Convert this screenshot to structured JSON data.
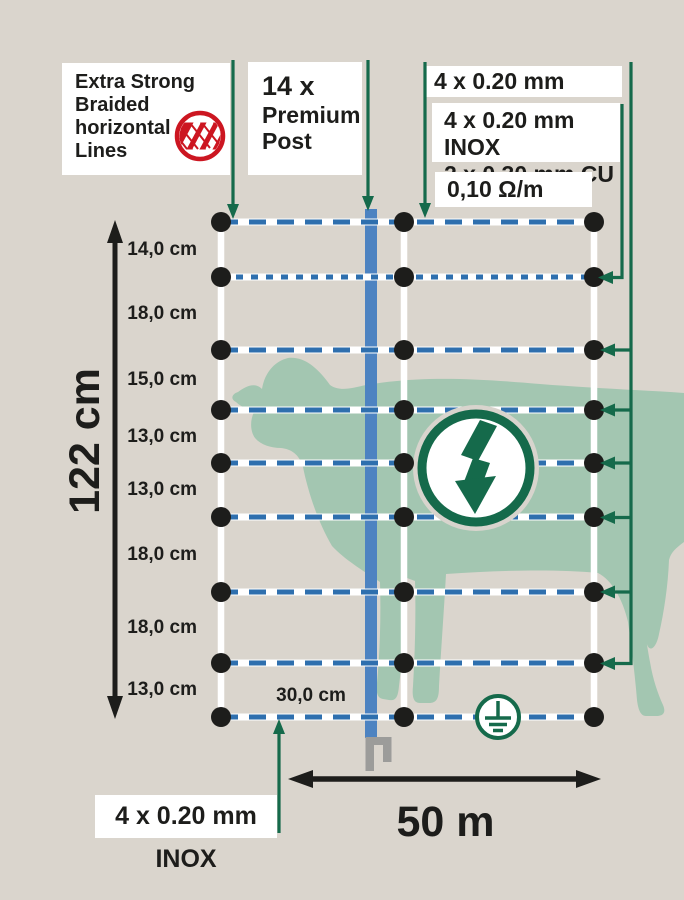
{
  "page": {
    "title": "Sheep netting product diagram",
    "background": "#dad5cd"
  },
  "colors": {
    "background": "#dad5cd",
    "accent_green": "#156a4b",
    "wire_blue": "#2e6fae",
    "post_blue": "#4d83c1",
    "sheep_green": "#a3c6b1",
    "logo_red": "#cc1621",
    "text_black": "#1d1d1b",
    "spike_gray": "#9c9c9a",
    "box_white": "#ffffff"
  },
  "braided_box": {
    "line1": "Extra Strong",
    "line2": "Braided",
    "line3": "horizontal",
    "line4": "Lines"
  },
  "post_box": {
    "count": "14 x",
    "line1": "Premium",
    "line2": "Post"
  },
  "labels": {
    "top_wire": "4 x 0.20 mm INOX",
    "conductors_line1": "4 x 0.20 mm INOX",
    "conductors_line2": "2 x 0.30 mm CU",
    "resistance": "0,10 Ω/m",
    "bottom_wire": "4 x 0.20 mm INOX",
    "net_height": "122 cm",
    "net_length": "50 m",
    "vertical_spacing": "30,0 cm"
  },
  "line_spacings": [
    "14,0 cm",
    "18,0 cm",
    "15,0 cm",
    "13,0 cm",
    "13,0 cm",
    "18,0 cm",
    "18,0 cm",
    "13,0 cm"
  ],
  "icons": {
    "braided": "braided-lines-logo",
    "lightning": "electric-lightning-icon",
    "earth": "ground-symbol-icon"
  }
}
